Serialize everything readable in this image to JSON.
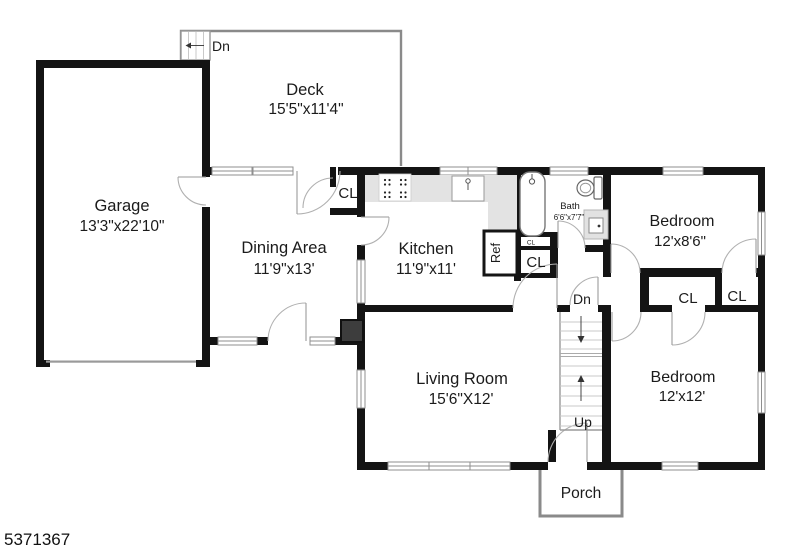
{
  "plan_id": "5371367",
  "rooms": {
    "deck": {
      "name": "Deck",
      "dims": "15'5\"x11'4\""
    },
    "garage": {
      "name": "Garage",
      "dims": "13'3\"x22'10\""
    },
    "dining": {
      "name": "Dining Area",
      "dims": "11'9\"x13'"
    },
    "kitchen": {
      "name": "Kitchen",
      "dims": "11'9\"x11'"
    },
    "bath": {
      "name": "Bath",
      "dims": "6'6\"x7'7\""
    },
    "bedroom_top": {
      "name": "Bedroom",
      "dims": "12'x8'6\""
    },
    "bedroom_bottom": {
      "name": "Bedroom",
      "dims": "12'x12'"
    },
    "living": {
      "name": "Living Room",
      "dims": "15'6\"X12'"
    },
    "porch": {
      "name": "Porch"
    }
  },
  "annotations": {
    "down": "Dn",
    "up": "Up",
    "closet": "CL",
    "fridge": "Ref"
  },
  "colors": {
    "wall": "#141414",
    "counter": "#e3e3e3",
    "chimney": "#3d3d3d",
    "deck_outline": "#8a8a8a"
  }
}
